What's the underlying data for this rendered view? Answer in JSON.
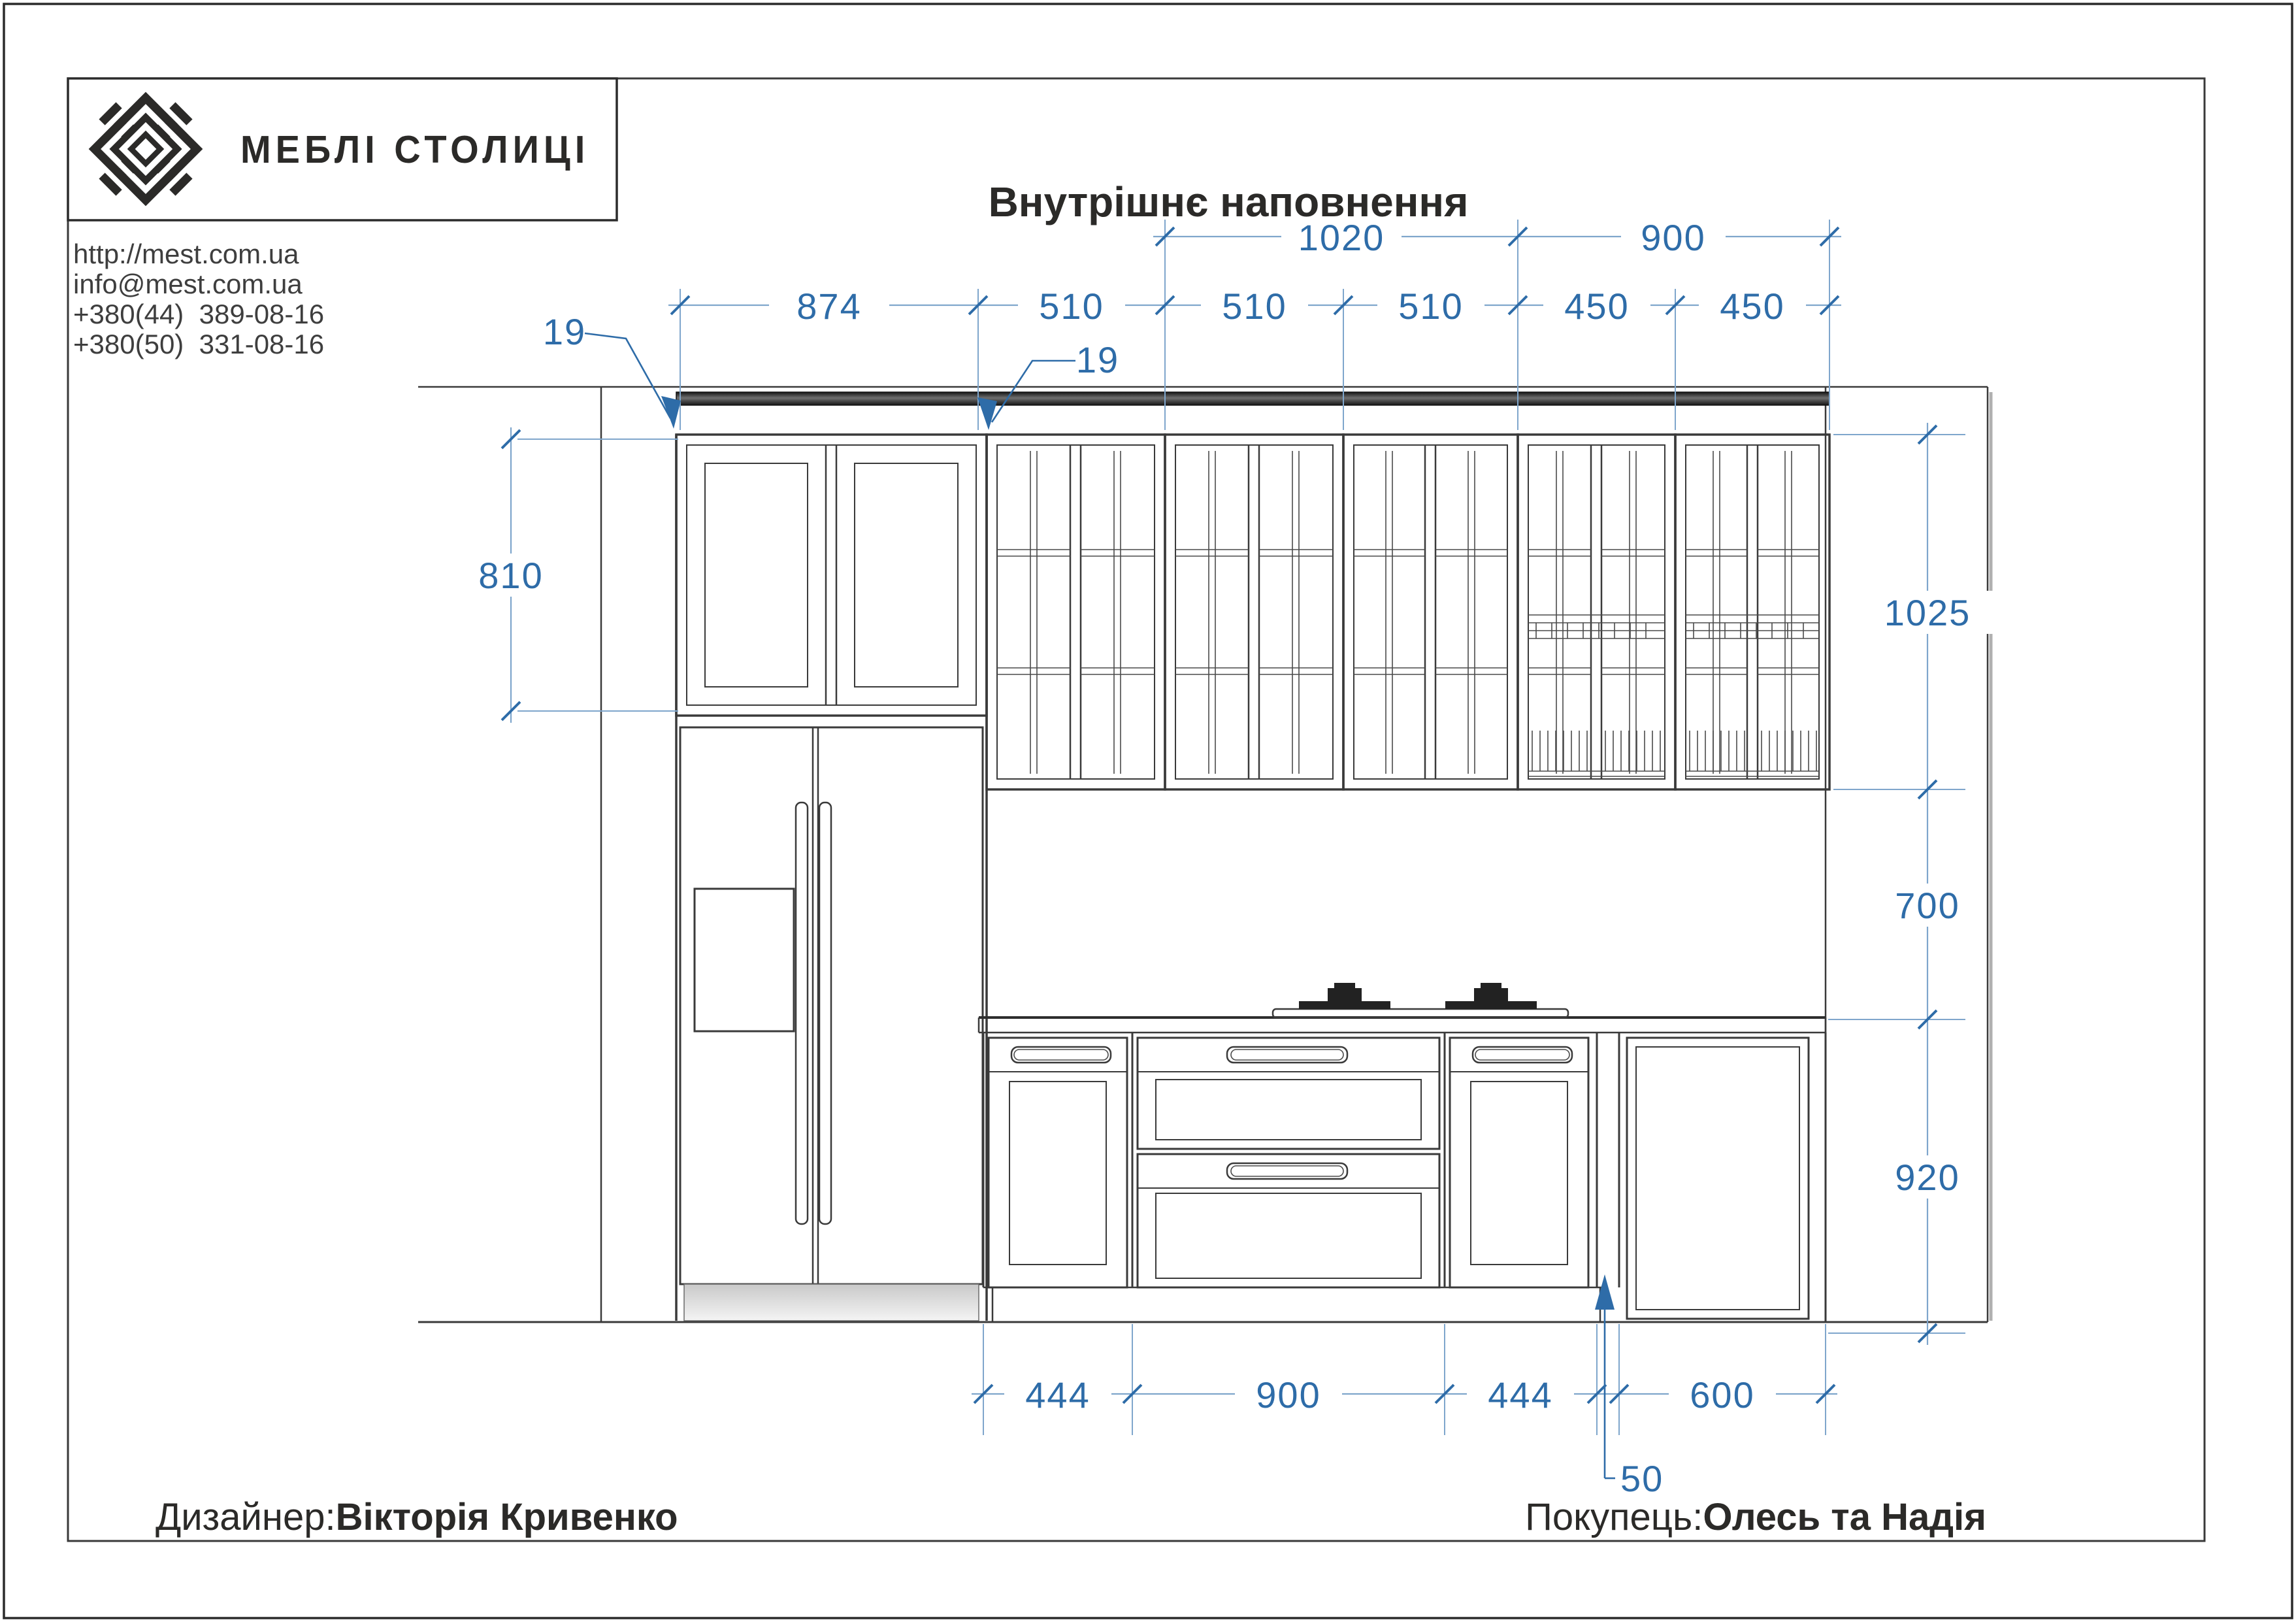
{
  "header": {
    "company_name": "МЕБЛІ СТОЛИЦІ",
    "website": "http://mest.com.ua",
    "email": "info@mest.com.ua",
    "phone1": "+380(44)  389-08-16",
    "phone2": "+380(50)  331-08-16"
  },
  "title": "Внутрішнє наповнення",
  "footer": {
    "designer_label": "Дизайнер:",
    "designer_name": "Вікторія Кривенко",
    "buyer_label": "Покупець:",
    "buyer_name": "Олесь та Надія"
  },
  "dimensions": {
    "upper_groups": [
      "1020",
      "900"
    ],
    "upper_units": [
      "874",
      "510",
      "510",
      "510",
      "450",
      "450"
    ],
    "panel_thickness_left": "19",
    "panel_thickness_right": "19",
    "tall_cabinet_height": "810",
    "wall_cabinet_height": "1025",
    "backsplash_height": "700",
    "base_height": "920",
    "base_units": [
      "444",
      "900",
      "444",
      "600"
    ],
    "filler_width": "50"
  },
  "colors": {
    "dimension_blue": "#2e6ca8",
    "dimension_line": "#7fa6cc",
    "drawing_line": "#3a3a3a"
  }
}
